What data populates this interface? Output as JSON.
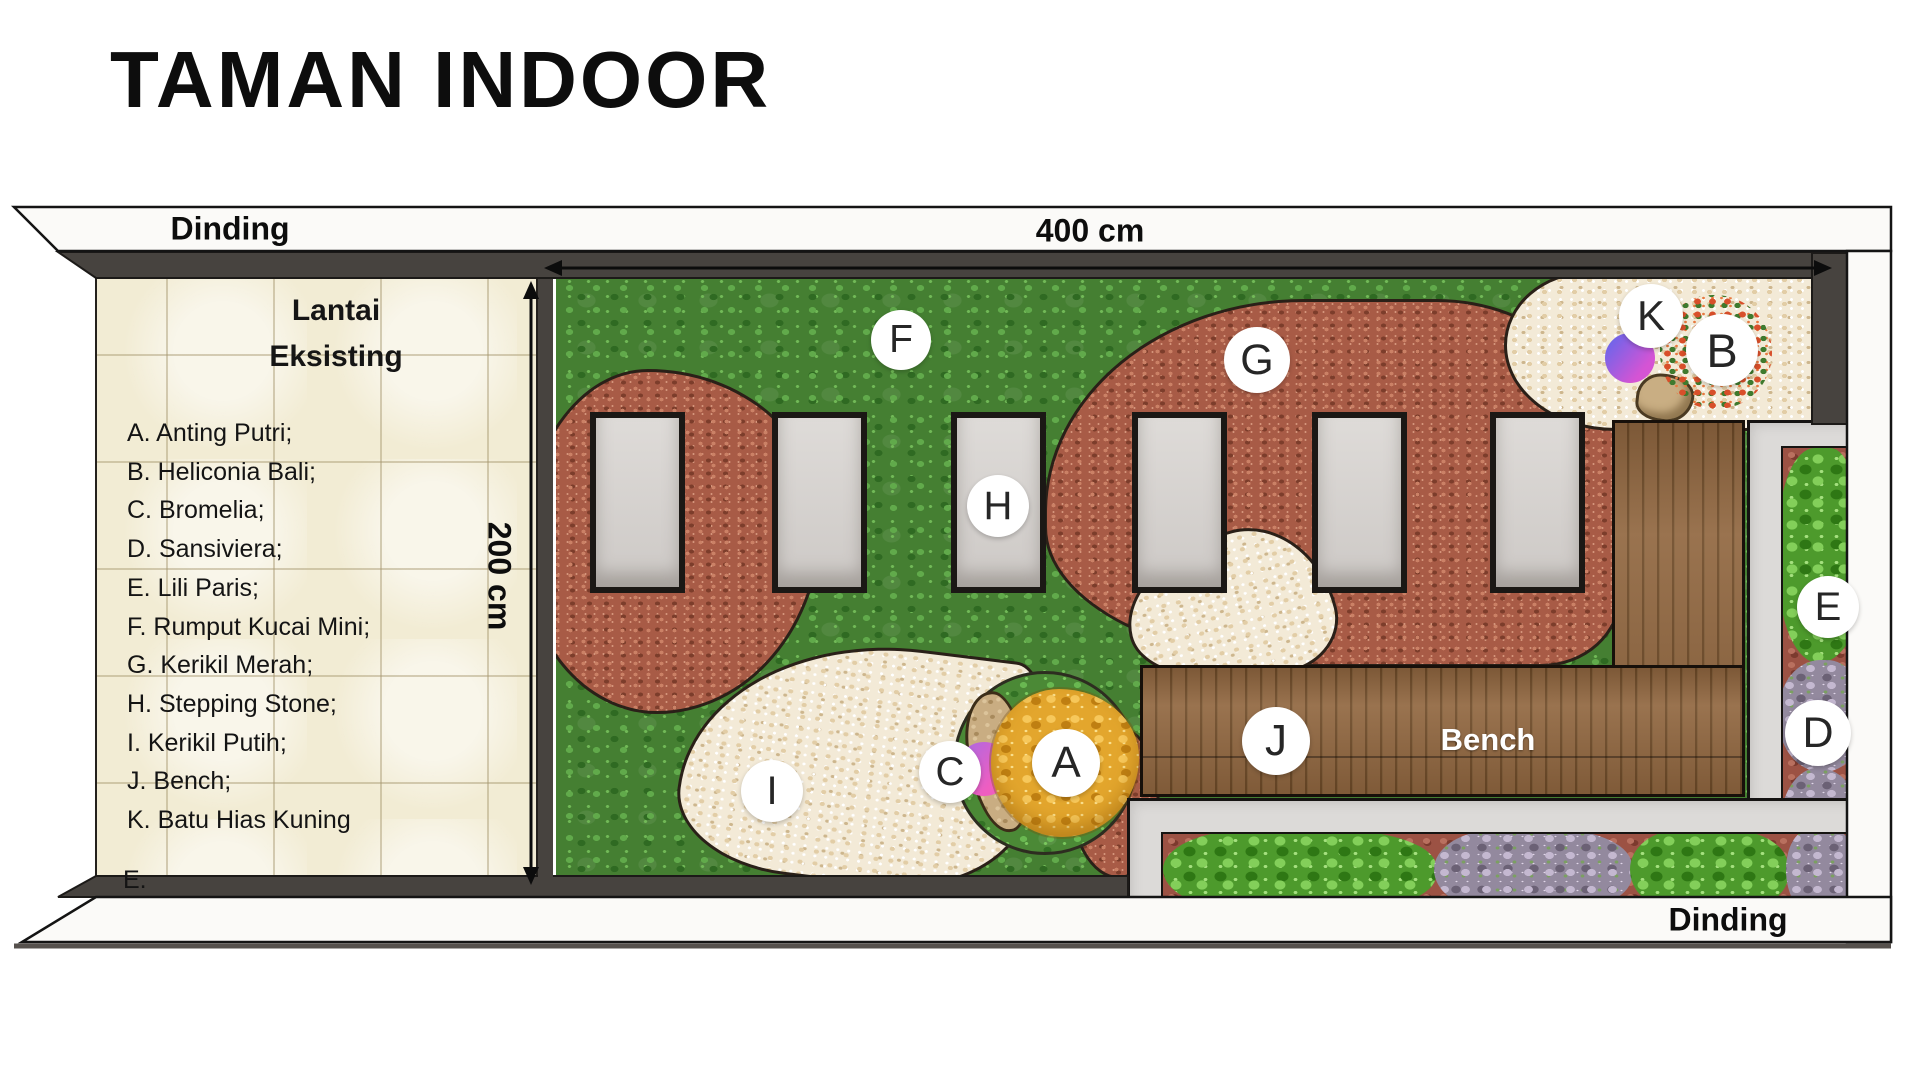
{
  "title": "TAMAN INDOOR",
  "walls": {
    "top_label": "Dinding",
    "bottom_label": "Dinding"
  },
  "dimensions": {
    "width_label": "400 cm",
    "height_label": "200 cm"
  },
  "floor": {
    "heading_line1": "Lantai",
    "heading_line2": "Eksisting",
    "cutoff_text": "E."
  },
  "legend": [
    "A. Anting Putri;",
    "B. Heliconia Bali;",
    "C. Bromelia;",
    "D. Sansiviera;",
    "E. Lili Paris;",
    "F. Rumput Kucai Mini;",
    "G. Kerikil Merah;",
    "H. Stepping Stone;",
    "I. Kerikil Putih;",
    "J. Bench;",
    "K. Batu Hias Kuning"
  ],
  "bench": {
    "label": "Bench"
  },
  "markers": [
    {
      "letter": "F",
      "x": 901,
      "y": 340,
      "r": 30
    },
    {
      "letter": "G",
      "x": 1257,
      "y": 360,
      "r": 33
    },
    {
      "letter": "H",
      "x": 998,
      "y": 506,
      "r": 31
    },
    {
      "letter": "I",
      "x": 772,
      "y": 791,
      "r": 31
    },
    {
      "letter": "C",
      "x": 950,
      "y": 772,
      "r": 31
    },
    {
      "letter": "A",
      "x": 1066,
      "y": 763,
      "r": 34
    },
    {
      "letter": "J",
      "x": 1276,
      "y": 741,
      "r": 34
    },
    {
      "letter": "K",
      "x": 1651,
      "y": 316,
      "r": 32
    },
    {
      "letter": "B",
      "x": 1722,
      "y": 350,
      "r": 36
    },
    {
      "letter": "E",
      "x": 1828,
      "y": 607,
      "r": 31
    },
    {
      "letter": "D",
      "x": 1818,
      "y": 733,
      "r": 33
    }
  ],
  "colors": {
    "grass": "#457f32",
    "red_gravel": "#a85b46",
    "white_gravel": "#f3ead7",
    "wood": "#8a6038",
    "wall_dark": "#47433f",
    "wall_light": "#fbfaf8",
    "tile": "#f2ecd4",
    "planter": "#dcdad8",
    "bed": "#9c5244",
    "tree_orange": "#e3a62d",
    "accent_purple": "#5a68ee",
    "accent_pink": "#ef5ec0"
  }
}
